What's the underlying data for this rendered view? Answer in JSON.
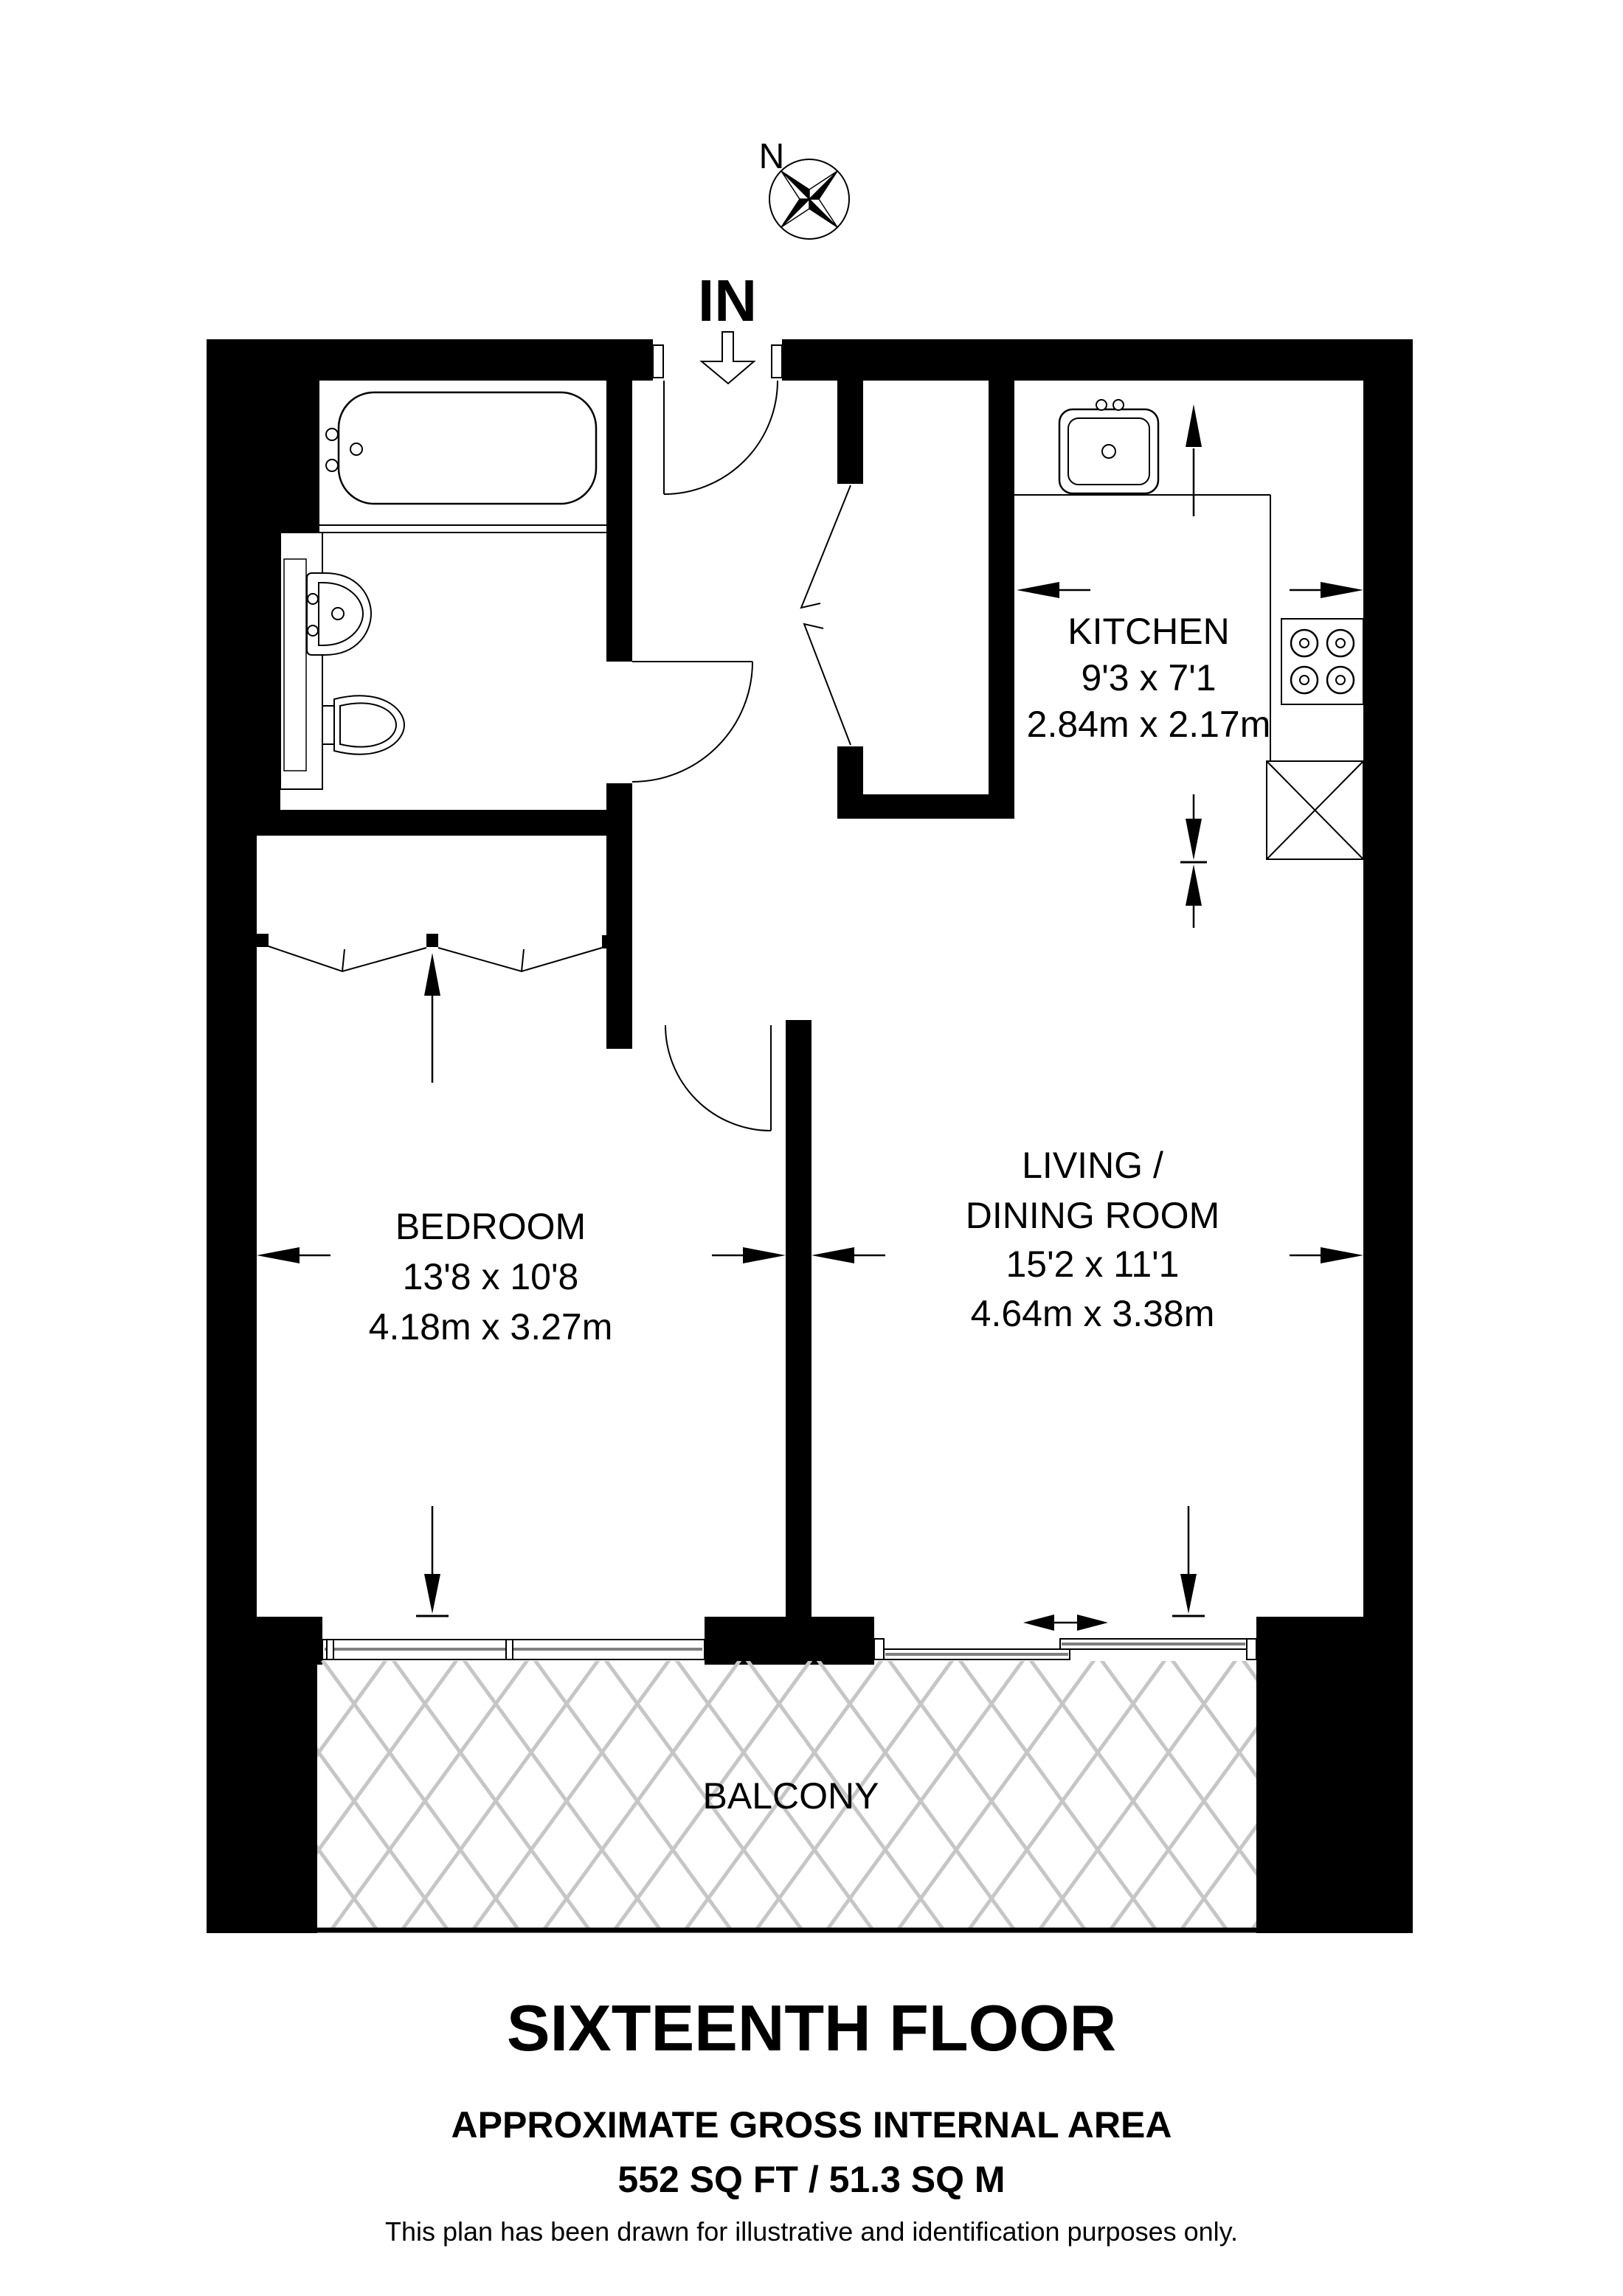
{
  "compass": {
    "north_label": "N",
    "icon": "compass-rose-icon"
  },
  "entrance": {
    "label": "IN",
    "icon": "entry-arrow-icon"
  },
  "rooms": {
    "kitchen": {
      "name": "KITCHEN",
      "size_imperial": "9'3 x 7'1",
      "size_metric": "2.84m x 2.17m"
    },
    "living": {
      "name_line1": "LIVING /",
      "name_line2": "DINING ROOM",
      "size_imperial": "15'2 x 11'1",
      "size_metric": "4.64m x 3.38m"
    },
    "bedroom": {
      "name": "BEDROOM",
      "size_imperial": "13'8 x 10'8",
      "size_metric": "4.18m x 3.27m"
    },
    "balcony": {
      "name": "BALCONY"
    }
  },
  "fixtures": {
    "bathroom": [
      "bathtub-icon",
      "basin-icon",
      "toilet-icon",
      "vanity-icon",
      "door-swing-icon"
    ],
    "kitchen": [
      "kitchen-sink-icon",
      "hob-icon",
      "appliance-crossbox-icon",
      "counter-line"
    ],
    "bedroom": [
      "wardrobe-sliding-doors-icon",
      "window-icon",
      "door-swing-icon"
    ],
    "living": [
      "sliding-door-icon",
      "slide-direction-arrow-icon"
    ],
    "hall": [
      "entrance-door-swing-icon",
      "cupboard-bifold-doors-icon"
    ]
  },
  "annotations": {
    "dimension_arrow": "solid-triangle-arrow",
    "balcony_hatch": "diamond-lattice"
  },
  "colors": {
    "wall": "#000000",
    "background": "#ffffff",
    "window_glass_line": "#7f7f7f",
    "hatch_line": "#c6c6c6"
  },
  "footer": {
    "floor_title": "SIXTEENTH FLOOR",
    "area_label": "APPROXIMATE GROSS INTERNAL AREA",
    "area_value": "552 SQ FT / 51.3 SQ M",
    "disclaimer": "This plan has been drawn for illustrative and identification purposes only."
  }
}
